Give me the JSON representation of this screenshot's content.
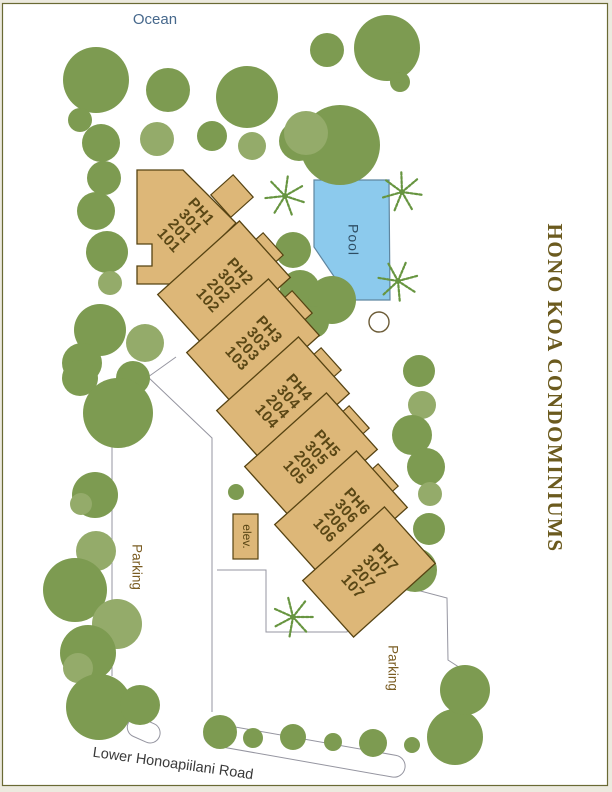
{
  "labels": {
    "ocean": "Ocean",
    "title": "HONO KOA CONDOMINIUMS",
    "road": "Lower Honoapiilani Road",
    "parking_west": "Parking",
    "parking_east": "Parking"
  },
  "pool": {
    "label": "Pool"
  },
  "elevator": {
    "label": "elev."
  },
  "buildings": {
    "units": [
      {
        "name": "PH1",
        "lines": [
          "PH1",
          "301",
          "201",
          "101"
        ]
      },
      {
        "name": "PH2",
        "lines": [
          "PH2",
          "302",
          "202",
          "102"
        ]
      },
      {
        "name": "PH3",
        "lines": [
          "PH3",
          "303",
          "203",
          "103"
        ]
      },
      {
        "name": "PH4",
        "lines": [
          "PH4",
          "304",
          "204",
          "104"
        ]
      },
      {
        "name": "PH5",
        "lines": [
          "PH5",
          "305",
          "205",
          "105"
        ]
      },
      {
        "name": "PH6",
        "lines": [
          "PH6",
          "306",
          "206",
          "106"
        ]
      },
      {
        "name": "PH7",
        "lines": [
          "PH7",
          "307",
          "207",
          "107"
        ]
      }
    ]
  },
  "icons": {
    "palm": "palm-tree-icon",
    "spa": "spa-circle",
    "tree": "tree-icon"
  },
  "colors": {
    "page_margin": "#eceadf",
    "map_background": "#ffffff",
    "map_border": "#6a6a34",
    "building_fill": "#ddb778",
    "building_stroke": "#564312",
    "unit_label": "#5a4715",
    "pool_fill": "#8ccaed",
    "pool_stroke": "#5f86a0",
    "pool_label": "#2e4d63",
    "tree_dark": "#7d9b51",
    "tree_light": "#94ab6a",
    "palm": "#679540",
    "ocean_label": "#46688c",
    "title": "#6b5a1e",
    "parking_label": "#7a5c22",
    "road_label": "#3a3a3a",
    "ground_line": "#9595a0",
    "spa_stroke": "#6b5b36"
  }
}
